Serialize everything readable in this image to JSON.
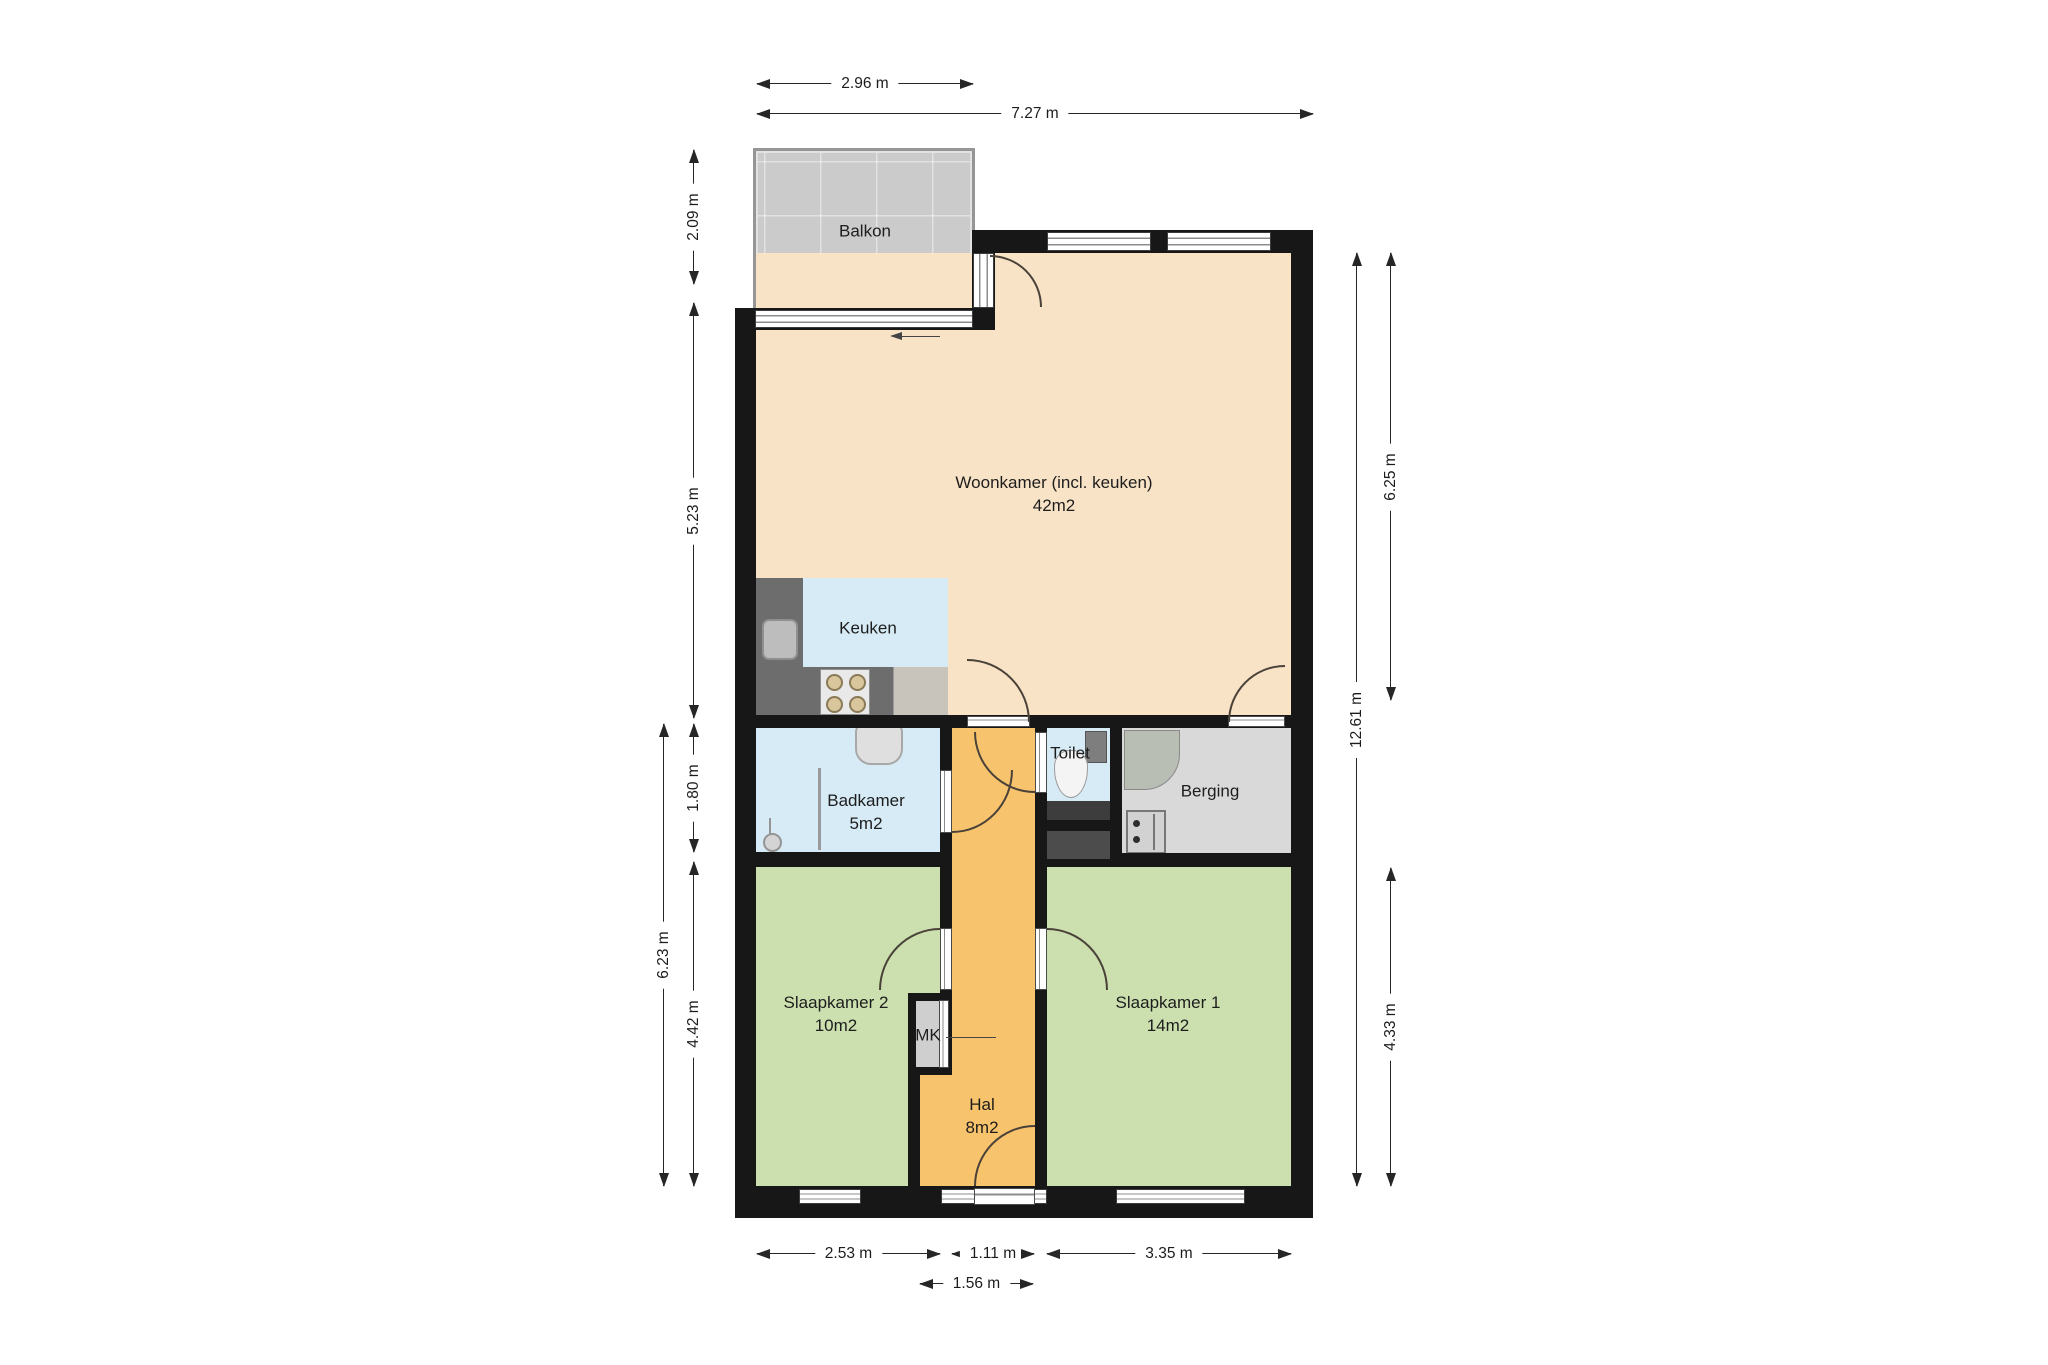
{
  "title": "Apartment floor plan",
  "rooms": {
    "balkon": {
      "label": "Balkon"
    },
    "woonkamer": {
      "label": "Woonkamer (incl. keuken)",
      "area": "42m2"
    },
    "keuken": {
      "label": "Keuken"
    },
    "badkamer": {
      "label": "Badkamer",
      "area": "5m2"
    },
    "toilet": {
      "label": "Toilet"
    },
    "berging": {
      "label": "Berging"
    },
    "slaapkamer1": {
      "label": "Slaapkamer 1",
      "area": "14m2"
    },
    "slaapkamer2": {
      "label": "Slaapkamer 2",
      "area": "10m2"
    },
    "hal": {
      "label": "Hal",
      "area": "8m2"
    },
    "mk": {
      "label": "MK"
    }
  },
  "dimensions": {
    "top": {
      "balcony_width": "2.96 m",
      "total_width": "7.27 m"
    },
    "left": {
      "balcony_depth": "2.09 m",
      "woonkamer": "5.23 m",
      "badkamer": "1.80 m",
      "lower_total": "6.23 m",
      "slaapkamer2": "4.42 m"
    },
    "right": {
      "woonkamer": "6.25 m",
      "total_height": "12.61 m",
      "slaapkamer1": "4.33 m"
    },
    "bottom": {
      "slaapkamer2": "2.53 m",
      "hal": "1.11 m",
      "slaapkamer1": "3.35 m",
      "entry": "1.56 m"
    }
  },
  "colors": {
    "wall": "#171717",
    "living": "#f8e3c6",
    "wet_room": "#d6ebf5",
    "bedroom": "#cbe0ae",
    "hall": "#f8c36d",
    "storage": "#d9d9d9",
    "balcony": "#cbcbcb",
    "counter": "#6d6d6d"
  }
}
